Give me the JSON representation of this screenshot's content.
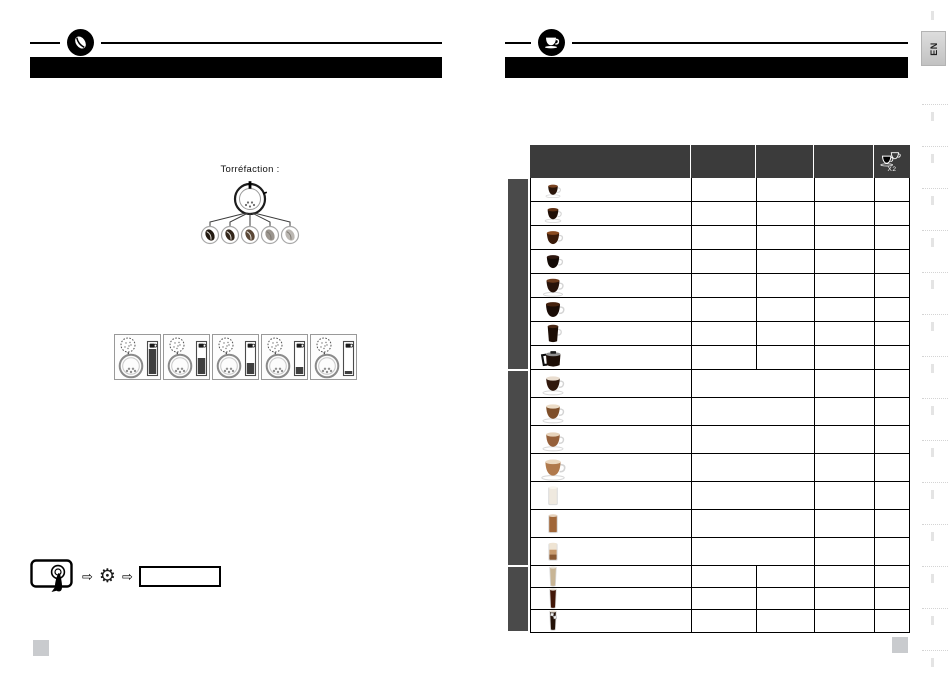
{
  "theme": {
    "page-bg": "#ffffff",
    "bar-black": "#000000",
    "table-header": "#3b3b3b",
    "group-sidebar": "#4a4a4a"
  },
  "left_page": {
    "ornament_icon": "coffee-bean-icon",
    "roast": {
      "label": "Torréfaction :",
      "levels": [
        {
          "name": "roast-level-1-darkest",
          "color": "#231a11"
        },
        {
          "name": "roast-level-2-dark",
          "color": "#33261a"
        },
        {
          "name": "roast-level-3-medium",
          "color": "#5a4736"
        },
        {
          "name": "roast-level-4-light",
          "color": "#9b958e"
        },
        {
          "name": "roast-level-5-lightest",
          "color": "#bbb7b2"
        }
      ]
    },
    "grind_settings": [
      {
        "name": "grind-setting-1",
        "gauge_fill": 1.0
      },
      {
        "name": "grind-setting-2",
        "gauge_fill": 0.62
      },
      {
        "name": "grind-setting-3",
        "gauge_fill": 0.45
      },
      {
        "name": "grind-setting-4",
        "gauge_fill": 0.28
      },
      {
        "name": "grind-setting-5",
        "gauge_fill": 0.1
      }
    ],
    "settings_sequence": [
      "touchscreen-icon",
      "arrow-right-icon",
      "gear-icon",
      "arrow-right-icon",
      "menu-item-bar"
    ]
  },
  "right_page": {
    "ornament_icon": "coffee-cup-icon",
    "table": {
      "header": {
        "x2_label": "X2",
        "x2_icon": "double-cup-icon",
        "column_count": 5
      },
      "groups": [
        {
          "name": "black-coffee-recipes",
          "merged_middle": false,
          "rows": [
            {
              "icon": "ristretto-cup-icon",
              "kind": "cup",
              "size": 0.72,
              "liquid": "#2a150a",
              "surface": "#7c4522",
              "saucer": true
            },
            {
              "icon": "espresso-cup-icon",
              "kind": "cup",
              "size": 0.8,
              "liquid": "#200f06",
              "surface": "#5e3013",
              "saucer": true
            },
            {
              "icon": "lungo-cup-icon",
              "kind": "cup",
              "size": 0.92,
              "liquid": "#3a1b0a",
              "surface": "#8a4b20",
              "saucer": false
            },
            {
              "icon": "doppio-cup-icon",
              "kind": "cup",
              "size": 0.92,
              "liquid": "#130a05",
              "surface": "#2f1810",
              "saucer": false
            },
            {
              "icon": "coffee-cup-saucer-icon",
              "kind": "cup",
              "size": 0.97,
              "liquid": "#27130a",
              "surface": "#6b3a1c",
              "saucer": true
            },
            {
              "icon": "long-coffee-cup-icon",
              "kind": "cup",
              "size": 1.05,
              "liquid": "#1a0c06",
              "surface": "#45220e",
              "saucer": false
            },
            {
              "icon": "tall-mug-icon",
              "kind": "mug",
              "size": 1.0,
              "liquid": "#1d0e06",
              "surface": "#4a2815"
            },
            {
              "icon": "coffee-pot-icon",
              "kind": "carafe",
              "size": 1.05,
              "liquid": "#1c0d05"
            }
          ]
        },
        {
          "name": "milk-coffee-recipes",
          "merged_middle": true,
          "rows": [
            {
              "icon": "cappuccino-cup-icon",
              "kind": "cup",
              "size": 1.02,
              "liquid": "#31180c",
              "surface": "#e9ddcf",
              "saucer": true
            },
            {
              "icon": "flat-white-cup-icon",
              "kind": "cup",
              "size": 1.02,
              "liquid": "#7e4e29",
              "surface": "#ecdcc7",
              "saucer": true
            },
            {
              "icon": "caffe-latte-cup-icon",
              "kind": "cup",
              "size": 1.02,
              "liquid": "#96603a",
              "surface": "#e7d3bb",
              "saucer": true
            },
            {
              "icon": "latte-macchiato-cup-icon",
              "kind": "cup",
              "size": 1.14,
              "liquid": "#b0794c",
              "surface": "#ecd9c1",
              "saucer": true
            },
            {
              "icon": "hot-milk-glass-icon",
              "kind": "glass",
              "size": 1.05,
              "liquid": "#efe9df",
              "surface": "#f8f5ee"
            },
            {
              "icon": "caffe-latte-glass-icon",
              "kind": "glass",
              "size": 1.05,
              "liquid": "#a06638",
              "surface": "#e5d1bc"
            },
            {
              "icon": "layered-macchiato-glass-icon",
              "kind": "glass",
              "size": 1.0,
              "liquid": "#c89b6e",
              "surface": "#efe4d3",
              "layers": [
                "#8a5a33",
                "#c89b6e",
                "#efe4d3"
              ]
            }
          ]
        },
        {
          "name": "iced-recipes",
          "merged_middle": false,
          "rows": [
            {
              "icon": "iced-latte-glass-icon",
              "kind": "tallglass",
              "size": 1.0,
              "liquid": "#c8b595"
            },
            {
              "icon": "iced-coffee-glass-icon",
              "kind": "tallglass",
              "size": 1.0,
              "liquid": "#431809"
            },
            {
              "icon": "iced-americano-glass-icon",
              "kind": "tallglass",
              "size": 1.0,
              "liquid": "#241208",
              "ice": true
            }
          ]
        }
      ]
    }
  },
  "language_tab": {
    "label": "EN"
  }
}
